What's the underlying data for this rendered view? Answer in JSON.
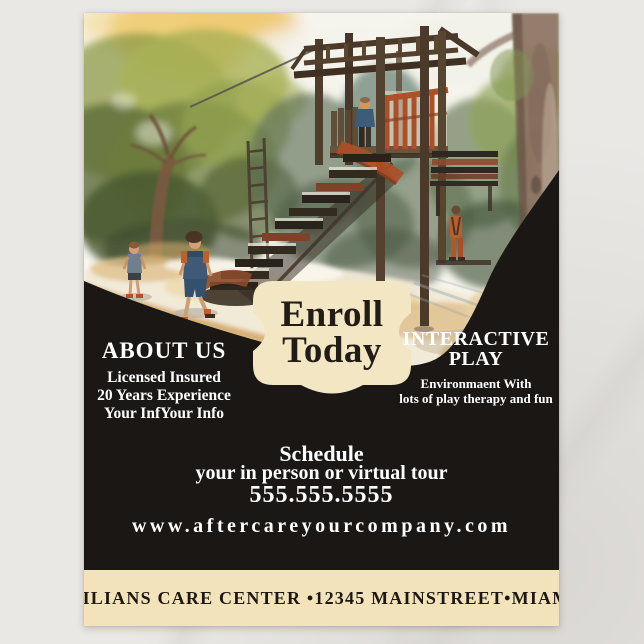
{
  "colors": {
    "marble": "#eae8e5",
    "panel_black": "#1a1715",
    "cream": "#f2e3bb",
    "badge_cream": "#f3e6c3",
    "text_white": "#ffffff",
    "footer_text": "#1d1813",
    "accent_orange": "#b05229"
  },
  "artwork": {
    "alt": "Watercolor illustration of children playing at a wooden playground with a climbing tower, stair slide, monkey bars, trees and a sandy path"
  },
  "badge": {
    "line1": "Enroll",
    "line2": "Today"
  },
  "about": {
    "heading": "ABOUT US",
    "lines": [
      "Licensed Insured",
      "20 Years Experience",
      "Your InfYour Info"
    ]
  },
  "interactive_play": {
    "heading_line1": "INTERACTIVE",
    "heading_line2": "PLAY",
    "lines": [
      "Environmaent With",
      "lots of play therapy and fun"
    ]
  },
  "schedule": {
    "heading": "Schedule",
    "subheading": "your in person or virtual tour",
    "phone": "555.555.5555",
    "website": "www.aftercareyourcompany.com"
  },
  "footer": {
    "text": "MILIANS CARE CENTER •12345 MAINSTREET•MIAMI"
  }
}
